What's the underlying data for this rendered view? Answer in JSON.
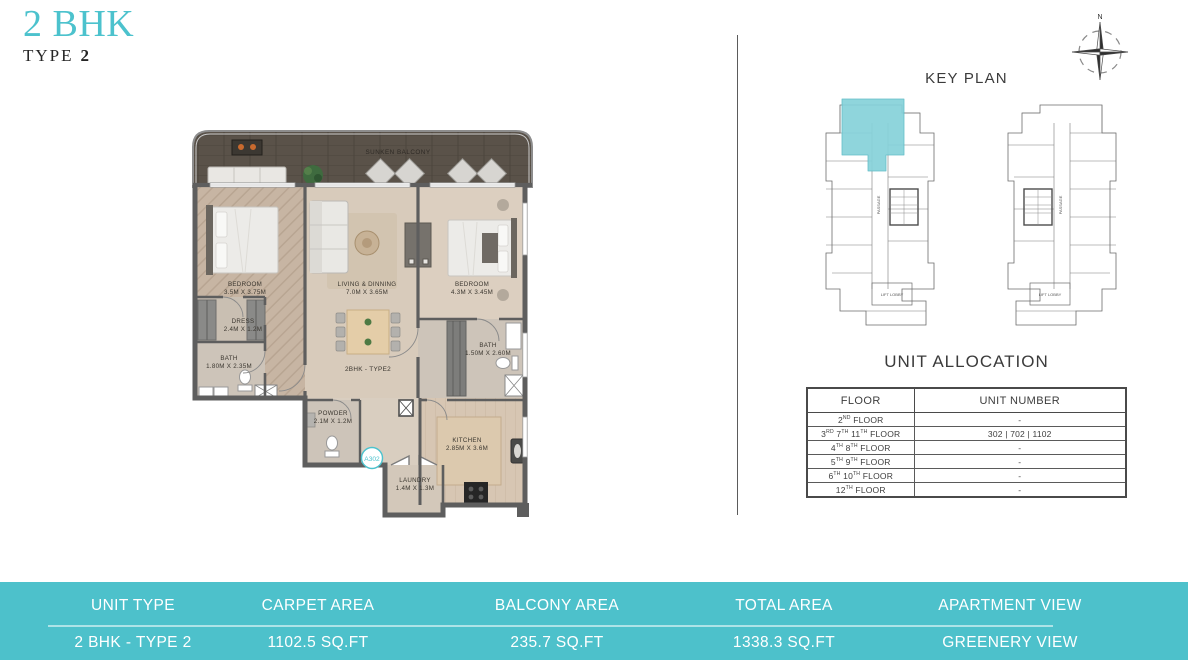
{
  "theme": {
    "accent_color": "#4cc2cd",
    "bar_bg_color": "#4dc1cb",
    "keyplan_highlight_color": "#86d2da"
  },
  "page": {
    "title_main": "2 BHK",
    "title_sub_label": "TYPE",
    "title_sub_number": "2"
  },
  "floor_plan": {
    "plan_label": "2BHK - TYPE2",
    "unit_badge": "A302",
    "rooms": [
      {
        "name": "SUNKEN BALCONY",
        "dims": ""
      },
      {
        "name": "BEDROOM",
        "dims": "3.5M X 3.75M"
      },
      {
        "name": "LIVING & DINNING",
        "dims": "7.0M X 3.65M"
      },
      {
        "name": "BEDROOM",
        "dims": "4.3M X 3.45M"
      },
      {
        "name": "DRESS",
        "dims": "2.4M X 1.2M"
      },
      {
        "name": "BATH",
        "dims": "1.80M X 2.35M"
      },
      {
        "name": "BATH",
        "dims": "1.50M X 2.60M"
      },
      {
        "name": "POWDER",
        "dims": "2.1M X 1.2M"
      },
      {
        "name": "KITCHEN",
        "dims": "2.85M X 3.6M"
      },
      {
        "name": "LAUNDRY",
        "dims": "1.4M X 1.3M"
      }
    ]
  },
  "key_plan": {
    "title": "KEY PLAN",
    "compass_label": "N",
    "passage_label": "PASSAGE",
    "lift_lobby_label": "LIFT LOBBY"
  },
  "unit_allocation": {
    "title": "UNIT ALLOCATION",
    "headers": [
      "FLOOR",
      "UNIT NUMBER"
    ],
    "rows": [
      {
        "floor": [
          {
            "t": "2"
          },
          {
            "t": "ND",
            "sup": true
          },
          {
            "t": " FLOOR"
          }
        ],
        "unit": "-"
      },
      {
        "floor": [
          {
            "t": "3"
          },
          {
            "t": "RD",
            "sup": true
          },
          {
            "t": " 7"
          },
          {
            "t": "TH",
            "sup": true
          },
          {
            "t": " 11"
          },
          {
            "t": "TH",
            "sup": true
          },
          {
            "t": " FLOOR"
          }
        ],
        "unit": "302 | 702 | 1102"
      },
      {
        "floor": [
          {
            "t": "4"
          },
          {
            "t": "TH",
            "sup": true
          },
          {
            "t": " 8"
          },
          {
            "t": "TH",
            "sup": true
          },
          {
            "t": " FLOOR"
          }
        ],
        "unit": "-"
      },
      {
        "floor": [
          {
            "t": "5"
          },
          {
            "t": "TH",
            "sup": true
          },
          {
            "t": " 9"
          },
          {
            "t": "TH",
            "sup": true
          },
          {
            "t": " FLOOR"
          }
        ],
        "unit": "-"
      },
      {
        "floor": [
          {
            "t": "6"
          },
          {
            "t": "TH",
            "sup": true
          },
          {
            "t": " 10"
          },
          {
            "t": "TH",
            "sup": true
          },
          {
            "t": " FLOOR"
          }
        ],
        "unit": "-"
      },
      {
        "floor": [
          {
            "t": "12"
          },
          {
            "t": "TH",
            "sup": true
          },
          {
            "t": " FLOOR"
          }
        ],
        "unit": "-"
      }
    ]
  },
  "summary_bar": {
    "columns": [
      {
        "header": "UNIT TYPE",
        "value": "2 BHK - TYPE 2"
      },
      {
        "header": "CARPET AREA",
        "value": "1102.5 SQ.FT"
      },
      {
        "header": "BALCONY AREA",
        "value": "235.7 SQ.FT"
      },
      {
        "header": "TOTAL AREA",
        "value": "1338.3 SQ.FT"
      },
      {
        "header": "APARTMENT VIEW",
        "value": "GREENERY VIEW"
      }
    ]
  }
}
